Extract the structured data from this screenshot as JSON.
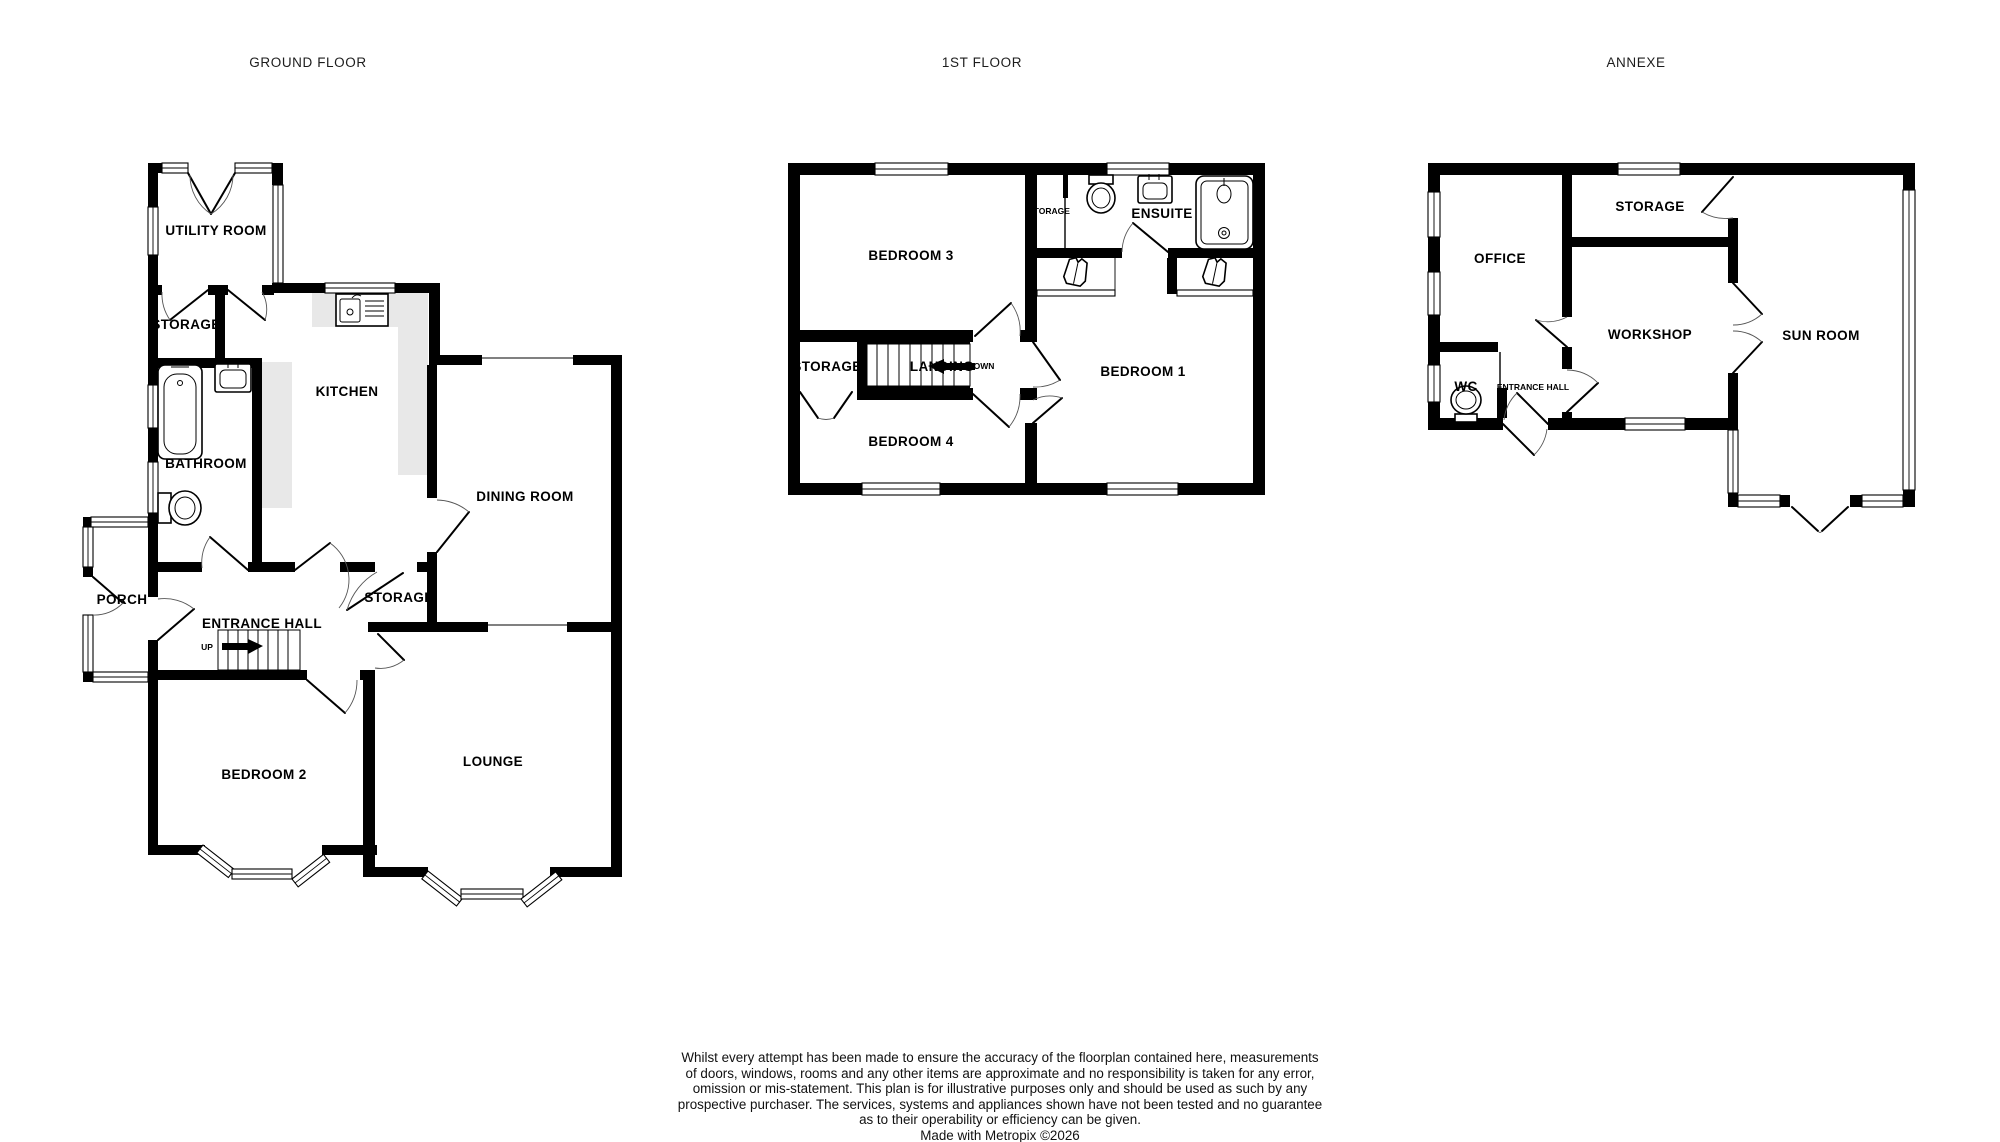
{
  "plans": {
    "ground_floor": {
      "title": "GROUND FLOOR",
      "rooms": {
        "utility_room": "UTILITY ROOM",
        "storage_upper": "STORAGE",
        "kitchen": "KITCHEN",
        "bathroom": "BATHROOM",
        "dining_room": "DINING ROOM",
        "porch": "PORCH",
        "entrance_hall": "ENTRANCE HALL",
        "storage_hall": "STORAGE",
        "bedroom_2": "BEDROOM 2",
        "lounge": "LOUNGE"
      },
      "stair_direction": "UP"
    },
    "first_floor": {
      "title": "1ST FLOOR",
      "rooms": {
        "bedroom_3": "BEDROOM 3",
        "storage_closet": "STORAGE",
        "ensuite": "ENSUITE",
        "bedroom_1": "BEDROOM 1",
        "bedroom_4": "BEDROOM 4",
        "storage": "STORAGE",
        "landing": "LANDING"
      },
      "stair_direction": "DOWN"
    },
    "annexe": {
      "title": "ANNEXE",
      "rooms": {
        "office": "OFFICE",
        "storage": "STORAGE",
        "workshop": "WORKSHOP",
        "sun_room": "SUN ROOM",
        "wc": "WC",
        "entrance_hall": "ENTRANCE HALL"
      }
    }
  },
  "disclaimer": {
    "lines": [
      "Whilst every attempt has been made to ensure the accuracy of the floorplan contained here, measurements",
      "of doors, windows, rooms and any other items are approximate and no responsibility is taken for any error,",
      "omission or mis-statement. This plan is for illustrative purposes only and should be used as such by any",
      "prospective purchaser. The services, systems and appliances shown have not been tested and no guarantee",
      "as to their operability or efficiency can be given.",
      "Made with Metropix ©2026"
    ]
  },
  "colors": {
    "wall": "#000000",
    "counter": "#e8e8e8",
    "background": "#ffffff"
  }
}
